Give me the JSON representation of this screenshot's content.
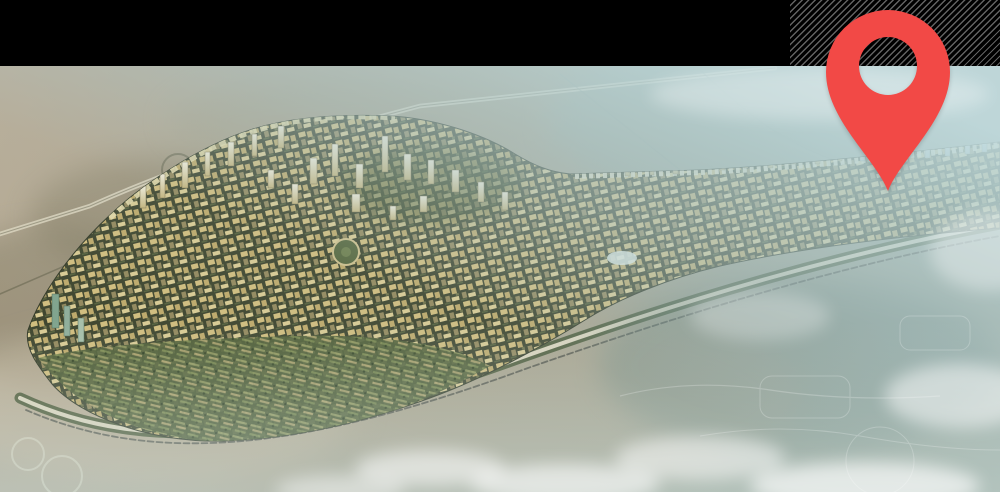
{
  "window": {
    "width_px": 1000,
    "height_px": 492
  },
  "header_bar": {
    "style": "solid black band",
    "right_texture": "thin diagonal gray stripes on black"
  },
  "marker": {
    "icon": "location-pin-icon",
    "shape": "teardrop map pin with transparent circular hole",
    "points_at": "high-rise corridor of the development"
  },
  "scene": {
    "description": "Aerial rendering of a desert master-planned community: a rounded triangular district dense with golden towers and curved green villa rows, a long corridor of high-rises stretching to the right, highway interchanges and a boundary road on sand, all fading into pale teal haze and white clouds toward the lower right",
    "palette": {
      "pin_red": "#F24946",
      "bar_black": "#000000",
      "desert_sand": "#B2A48D",
      "city_gold": "#D2BD7C",
      "greenery": "#4E5C33",
      "haze_teal": "#AEC9CD"
    }
  }
}
